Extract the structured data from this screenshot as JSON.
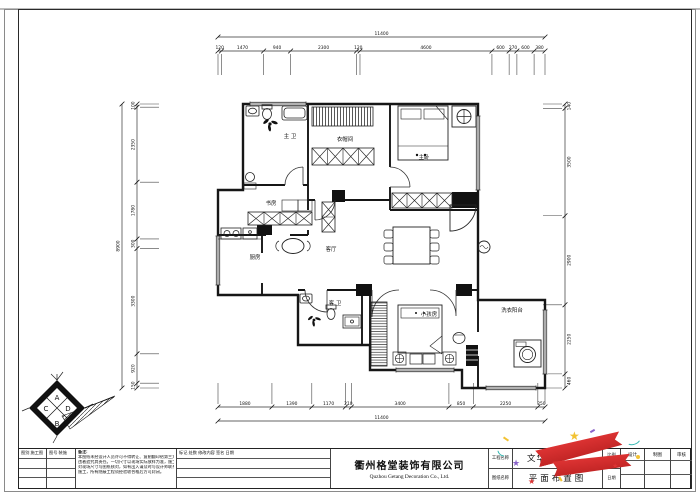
{
  "drawing": {
    "rooms": [
      {
        "name": "master-bathroom",
        "label": "主 卫"
      },
      {
        "name": "cloakroom",
        "label": "衣帽间"
      },
      {
        "name": "master-bedroom",
        "label": "主卧"
      },
      {
        "name": "study",
        "label": "书房"
      },
      {
        "name": "kitchen",
        "label": "厨房"
      },
      {
        "name": "living-room",
        "label": "客厅"
      },
      {
        "name": "guest-bathroom",
        "label": "客 卫"
      },
      {
        "name": "kids-room",
        "label": "小孩房"
      },
      {
        "name": "laundry-balcony",
        "label": "洗衣阳台"
      }
    ],
    "dimensions": {
      "top": {
        "total": "11400",
        "segments": [
          120,
          1470,
          940,
          2300,
          120,
          4600,
          600,
          270,
          600,
          380
        ]
      },
      "bottom": {
        "total": "11400",
        "segments": [
          1880,
          1390,
          1170,
          210,
          3400,
          850,
          2250,
          250
        ]
      },
      "left": {
        "total": "8900",
        "segments": [
          100,
          2350,
          1780,
          300,
          3300,
          920,
          150
        ]
      },
      "right": {
        "segments": [
          140,
          3500,
          2900,
          2250,
          460
        ]
      }
    },
    "logo": {
      "top": "A",
      "right": "D",
      "bottom": "B",
      "left": "C"
    }
  },
  "title_block": {
    "sheet_type_header": "图别 施工图",
    "sheet_no_header": "图号 装施",
    "notes_title": "备注:",
    "notes_lines": [
      "本图纸未经设计人员许可不得转让、复制翻印给第三方或用于其他项目，",
      "违者追究其责任。一切尺寸以现场实际放样为准，施工单位在施工前须",
      "对现场尺寸与图纸核对，如有出入请及时与设计师联系，经确认后方可",
      "施工，所有隐蔽工程须经验收合格后方可封闭。"
    ],
    "revision_header": "标记 处数 修改内容 签名 日期",
    "company_cn": "衢州格堂装饰有限公司",
    "company_en": "Quzhou Getang Decoration Co., Ltd.",
    "project_label": "工程名称",
    "drawing_label": "图纸名称",
    "project_name": "文华园",
    "drawing_name": "平面布置图",
    "scale_label": "比例",
    "scale_value": "1:100",
    "date_label": "日期",
    "date_value": "",
    "sign_cols": [
      "设计",
      "制图",
      "审核"
    ]
  },
  "decor": {
    "star": "★",
    "colors": {
      "ribbon_red": "#dd3333",
      "star_yellow": "#f2c233",
      "star_purple": "#8a63c9",
      "confetti_teal": "#35b8b2"
    }
  }
}
